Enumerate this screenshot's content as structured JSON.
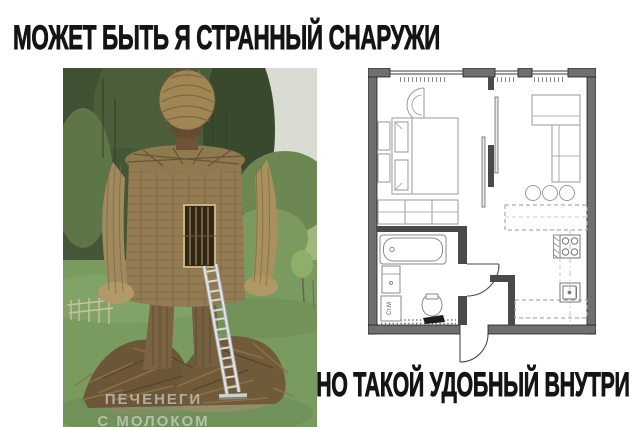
{
  "meme": {
    "top_caption": "МОЖЕТ БЫТЬ Я СТРАННЫЙ СНАРУЖИ",
    "bottom_caption": "НО ТАКОЙ УДОБНЫЙ ВНУТРИ"
  },
  "photo": {
    "subject": "wicker-man-sculpture-with-ladder-in-field",
    "watermark": {
      "line1": "ПЕЧЕНЕГИ",
      "line2": "С МОЛОКОМ"
    }
  },
  "floorplan": {
    "washing_machine_label": "Ст.М"
  },
  "colors": {
    "background": "#ffffff",
    "caption_text": "#141414",
    "plan_exterior_wall": "#6f6f6f",
    "plan_interior_wall": "#4a4a4a",
    "photo_forest_green": "#46583a",
    "photo_grass_green": "#7a9b60",
    "wicker_straw": "#a08a5e",
    "ladder_metal": "#dcdcdc"
  }
}
